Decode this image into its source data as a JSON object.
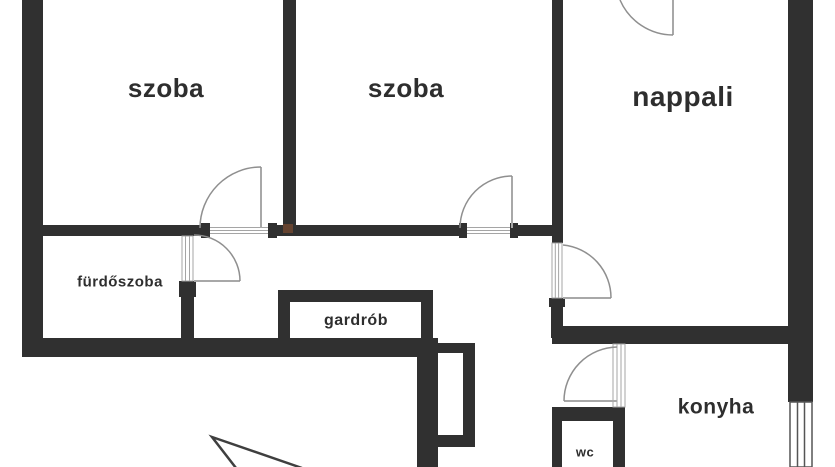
{
  "floor_plan": {
    "rooms": [
      {
        "id": "szoba-1",
        "label": "szoba"
      },
      {
        "id": "szoba-2",
        "label": "szoba"
      },
      {
        "id": "nappali",
        "label": "nappali"
      },
      {
        "id": "furdoszoba",
        "label": "fürdőszoba"
      },
      {
        "id": "gardrob",
        "label": "gardrób"
      },
      {
        "id": "konyha",
        "label": "konyha"
      },
      {
        "id": "wc",
        "label": "wc"
      }
    ],
    "colors": {
      "wall": "#303030",
      "background": "#ffffff",
      "door_swing": "#8f8f8f",
      "door_frame_line": "#a5a5a5",
      "label_text": "#2e2e2e",
      "entrance_arrow": "#3f3f3f",
      "junction_mark": "#6f4730"
    }
  }
}
